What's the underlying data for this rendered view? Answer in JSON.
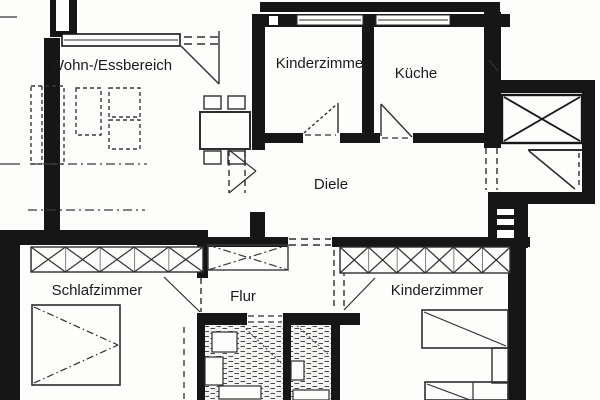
{
  "floorplan": {
    "type": "apartment-floor-plan",
    "rooms": [
      {
        "id": "wohn-essbereich",
        "label": "Wohn-/Essbereich"
      },
      {
        "id": "kinderzimmer-top",
        "label": "Kinderzimmer"
      },
      {
        "id": "kueche",
        "label": "Küche"
      },
      {
        "id": "diele",
        "label": "Diele"
      },
      {
        "id": "schlafzimmer",
        "label": "Schlafzimmer"
      },
      {
        "id": "flur",
        "label": "Flur"
      },
      {
        "id": "kinderzimmer-bottom",
        "label": "Kinderzimmer"
      }
    ],
    "elements": [
      "exterior-walls",
      "interior-walls",
      "window-bands",
      "door-swings",
      "wardrobe-x-boxes",
      "beds",
      "sofa-group",
      "dining-table-with-chairs",
      "elevator-shaft-x",
      "stair-landing",
      "stair-steps",
      "tiled-bathrooms",
      "bath-fixtures"
    ],
    "colors": {
      "wall": "#161616",
      "line": "#2e2e2e",
      "furniture_line": "#3a3a3a",
      "paper": "#fdfdfc",
      "tile_line": "#4a4a4a"
    }
  }
}
